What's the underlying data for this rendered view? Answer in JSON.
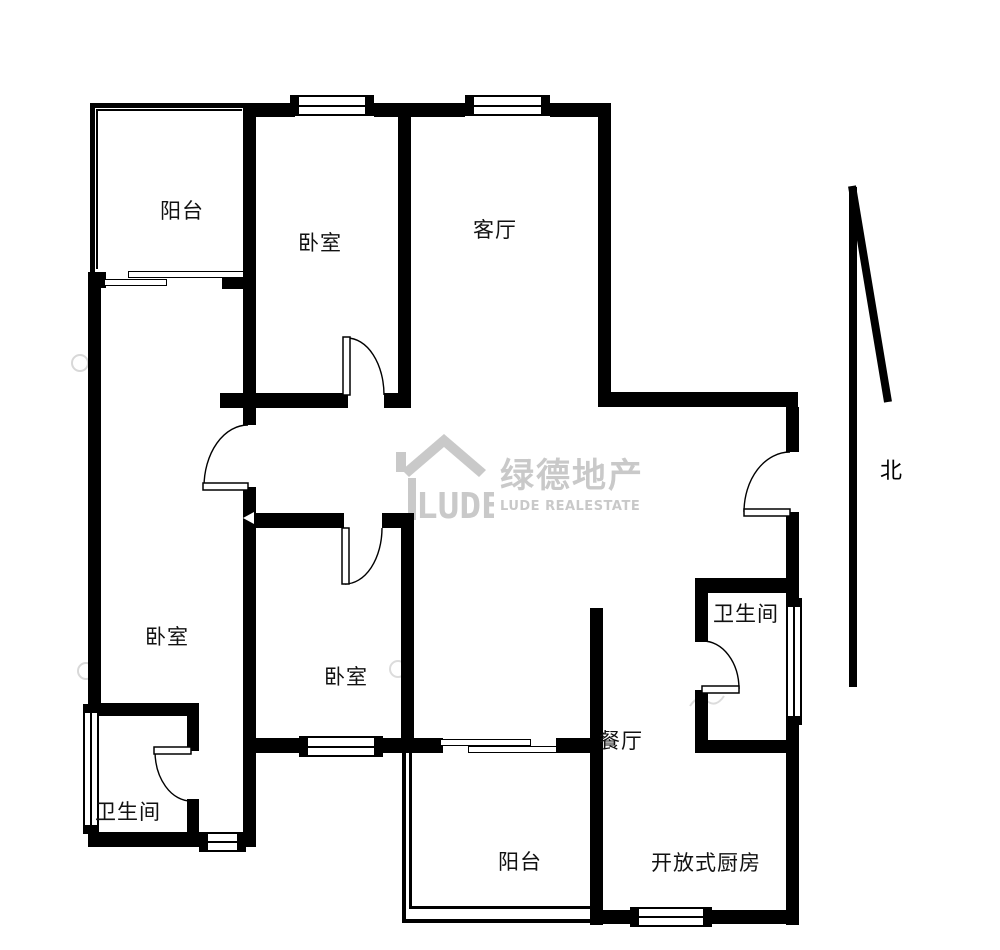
{
  "page": {
    "background": "#ffffff"
  },
  "floor_plan": {
    "rooms": [
      {
        "id": "balcony-top",
        "label": "阳台"
      },
      {
        "id": "bedroom-top",
        "label": "卧室"
      },
      {
        "id": "living-room",
        "label": "客厅"
      },
      {
        "id": "bedroom-left",
        "label": "卧室"
      },
      {
        "id": "bedroom-middle",
        "label": "卧室"
      },
      {
        "id": "bathroom-left",
        "label": "卫生间"
      },
      {
        "id": "bathroom-right",
        "label": "卫生间"
      },
      {
        "id": "dining-room",
        "label": "餐厅"
      },
      {
        "id": "balcony-bottom",
        "label": "阳台"
      },
      {
        "id": "open-kitchen",
        "label": "开放式厨房"
      }
    ],
    "compass": {
      "label": "北",
      "icon": "north-arrow"
    },
    "watermark": {
      "logo_text": "LUDE",
      "company_cn": "绿德地产",
      "company_en": "LUDE REALESTATE",
      "icon": "house-logo",
      "color": "#c9c9c9"
    },
    "colors": {
      "wall": "#000000",
      "label": "#111111"
    }
  }
}
